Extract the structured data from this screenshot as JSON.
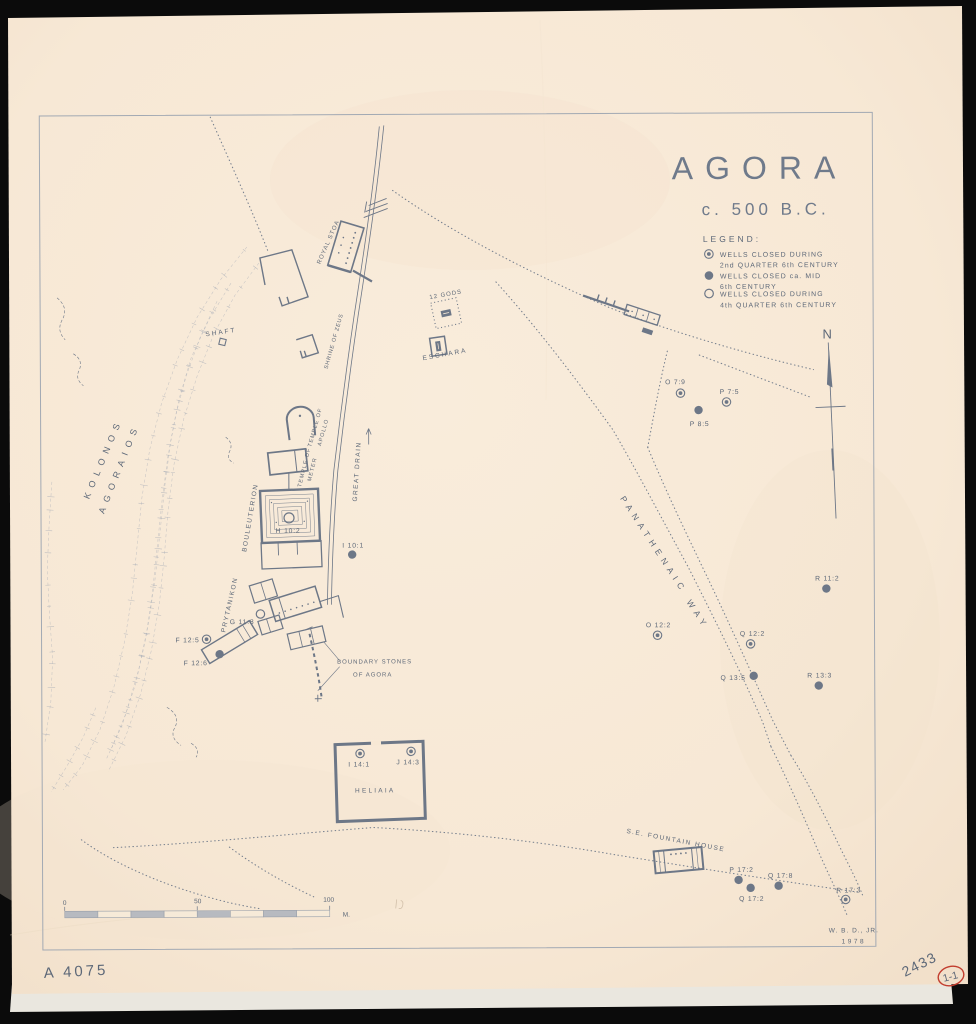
{
  "surface": {
    "catalog_number": "A 4075",
    "pencil_number": "2433",
    "stamp_number": "1-1"
  },
  "map": {
    "title": "AGORA",
    "subtitle": "c. 500 B.C.",
    "compass_letter": "N",
    "credit": {
      "line1": "W. B. D., JR.",
      "line2": "1978"
    },
    "legend": {
      "heading": "LEGEND:",
      "items": [
        {
          "symbol": "well-closed-2nd-quarter-icon",
          "line1": "WELLS CLOSED DURING",
          "line2": "2nd QUARTER 6th CENTURY"
        },
        {
          "symbol": "well-closed-mid-century-icon",
          "line1": "WELLS CLOSED ca. MID",
          "line2": "6th CENTURY"
        },
        {
          "symbol": "well-closed-4th-quarter-icon",
          "line1": "WELLS CLOSED DURING",
          "line2": "4th QUARTER 6th CENTURY"
        }
      ]
    },
    "scale_bar": {
      "start": "0",
      "middle": "50",
      "end": "100",
      "unit": "M."
    },
    "place_labels": [
      {
        "text": "KOLONOS",
        "x": 106,
        "y": 458,
        "r": -67,
        "fs": 9,
        "ls": 6
      },
      {
        "text": "AGORAIOS",
        "x": 122,
        "y": 468,
        "r": -68,
        "fs": 9,
        "ls": 6
      },
      {
        "text": "SHAFT",
        "x": 222,
        "y": 333,
        "r": -8,
        "fs": 6.5,
        "ls": 2
      },
      {
        "text": "ROYAL STOA",
        "x": 331,
        "y": 242,
        "r": -66,
        "fs": 6,
        "ls": 1
      },
      {
        "text": "SHRINE OF ZEUS",
        "x": 336,
        "y": 341,
        "r": -74,
        "fs": 5.5,
        "ls": 0.8
      },
      {
        "text": "12 GODS",
        "x": 447,
        "y": 296,
        "r": -10,
        "fs": 6,
        "ls": 1
      },
      {
        "text": "ESCHARA",
        "x": 446,
        "y": 356,
        "r": -10,
        "fs": 6.5,
        "ls": 2
      },
      {
        "text": "TEMPLE OF",
        "x": 317,
        "y": 427,
        "r": -74,
        "fs": 5.5,
        "ls": 1
      },
      {
        "text": "APOLLO",
        "x": 325,
        "y": 432,
        "r": -74,
        "fs": 5.5,
        "ls": 1
      },
      {
        "text": "TEMPLE OF",
        "x": 306,
        "y": 467,
        "r": -76,
        "fs": 5.5,
        "ls": 1
      },
      {
        "text": "METER",
        "x": 314,
        "y": 469,
        "r": -76,
        "fs": 5.5,
        "ls": 1
      },
      {
        "text": "BOULEUTERION",
        "x": 252,
        "y": 517,
        "r": -80,
        "fs": 6.5,
        "ls": 1.5
      },
      {
        "text": "GREAT DRAIN",
        "x": 359,
        "y": 471,
        "r": -86,
        "fs": 6.5,
        "ls": 1.5
      },
      {
        "text": "PRYTANIKON",
        "x": 231,
        "y": 604,
        "r": -77,
        "fs": 6.5,
        "ls": 1.5
      },
      {
        "text": "PANATHENAIC",
        "x": 651,
        "y": 547,
        "r": 57,
        "fs": 8.5,
        "ls": 5
      },
      {
        "text": "WAY",
        "x": 695,
        "y": 617,
        "r": 57,
        "fs": 8.5,
        "ls": 5
      },
      {
        "text": "BOUNDARY STONES",
        "x": 374,
        "y": 663,
        "r": 0,
        "fs": 6,
        "ls": 1
      },
      {
        "text": "OF AGORA",
        "x": 372,
        "y": 676,
        "r": 0,
        "fs": 6,
        "ls": 1
      },
      {
        "text": "HELIAIA",
        "x": 374,
        "y": 792,
        "r": 0,
        "fs": 6.5,
        "ls": 2.2
      },
      {
        "text": "S.E. FOUNTAIN HOUSE",
        "x": 674,
        "y": 843,
        "r": 11,
        "fs": 6.5,
        "ls": 1.5
      }
    ],
    "wells": [
      {
        "id": "O 7:9",
        "type": "quarter2",
        "x": 681,
        "y": 394,
        "lx": 676,
        "ly": 385
      },
      {
        "id": "P 7:5",
        "type": "quarter2",
        "x": 727,
        "y": 403,
        "lx": 730,
        "ly": 395
      },
      {
        "id": "P 8:5",
        "type": "mid",
        "x": 699,
        "y": 411,
        "lx": 700,
        "ly": 427
      },
      {
        "id": "R 11:2",
        "type": "mid",
        "x": 826,
        "y": 590,
        "lx": 827,
        "ly": 582
      },
      {
        "id": "O 12:2",
        "type": "quarter2",
        "x": 657,
        "y": 636,
        "lx": 658,
        "ly": 628
      },
      {
        "id": "Q 12:2",
        "type": "quarter2",
        "x": 750,
        "y": 645,
        "lx": 752,
        "ly": 637
      },
      {
        "id": "Q 13:5",
        "type": "mid",
        "x": 753,
        "y": 677,
        "lx": 745,
        "ly": 681,
        "a": "end"
      },
      {
        "id": "R 13:3",
        "type": "mid",
        "x": 818,
        "y": 687,
        "lx": 819,
        "ly": 679
      },
      {
        "id": "I 10:1",
        "type": "mid",
        "x": 352,
        "y": 554,
        "lx": 353,
        "ly": 547
      },
      {
        "id": "H 10:2",
        "type": "quarter4",
        "x": 289,
        "y": 517,
        "lx": 288,
        "ly": 532,
        "r": 5
      },
      {
        "id": "G 11:8",
        "type": "quarter4",
        "x": 260,
        "y": 613,
        "lx": 254,
        "ly": 623,
        "a": "end"
      },
      {
        "id": "F 12:5",
        "type": "quarter2",
        "x": 206,
        "y": 638,
        "lx": 199,
        "ly": 641,
        "a": "end"
      },
      {
        "id": "F 12:6",
        "type": "mid",
        "x": 219,
        "y": 653,
        "lx": 207,
        "ly": 664,
        "a": "end"
      },
      {
        "id": "I 14:1",
        "type": "quarter2",
        "x": 359,
        "y": 753,
        "lx": 358,
        "ly": 766
      },
      {
        "id": "J 14:3",
        "type": "quarter2",
        "x": 410,
        "y": 751,
        "lx": 407,
        "ly": 764
      },
      {
        "id": "P 17:2",
        "type": "mid",
        "x": 737,
        "y": 881,
        "lx": 740,
        "ly": 873
      },
      {
        "id": "Q 17:2",
        "type": "mid",
        "x": 749,
        "y": 889,
        "lx": 750,
        "ly": 902
      },
      {
        "id": "Q 17:8",
        "type": "mid",
        "x": 777,
        "y": 887,
        "lx": 779,
        "ly": 879
      },
      {
        "id": "R 17:3",
        "type": "quarter2",
        "x": 844,
        "y": 901,
        "lx": 847,
        "ly": 894
      }
    ]
  }
}
